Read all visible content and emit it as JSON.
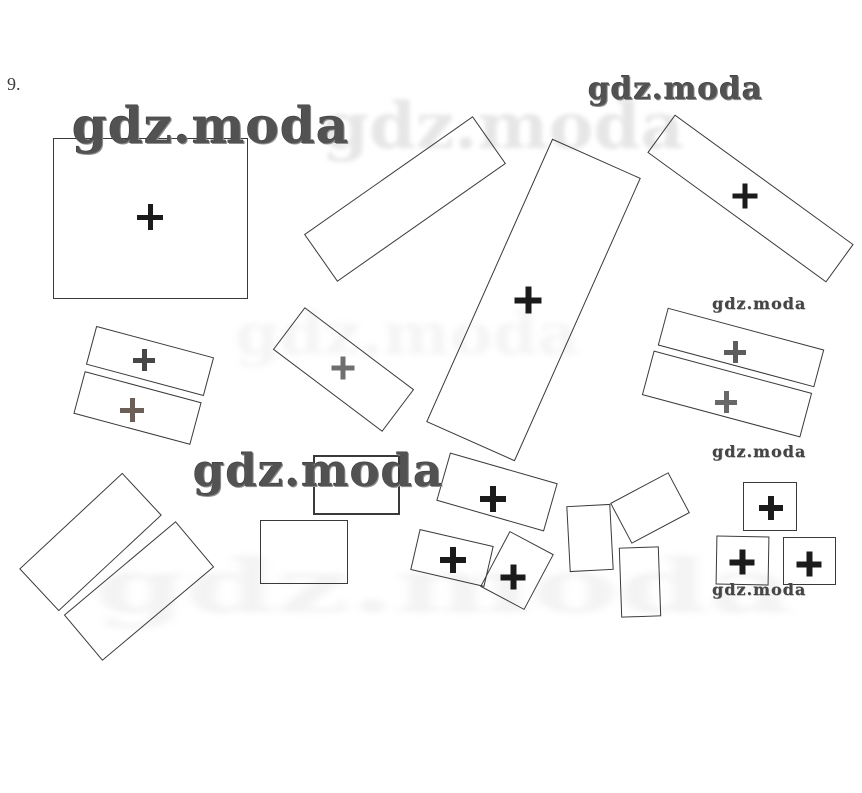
{
  "page": {
    "problem_number": "9.",
    "background": "#ffffff",
    "description": "Scanned workbook exercise: scattered rectangles, some marked with plus signs"
  },
  "watermark_text": "gdz.moda",
  "watermarks": [
    {
      "text": "gdz.moda",
      "x": 72,
      "y": 101,
      "font": 50,
      "style": "big"
    },
    {
      "text": "gdz.moda",
      "x": 193,
      "y": 448,
      "font": 45,
      "style": "big"
    },
    {
      "text": "gdz.moda",
      "x": 588,
      "y": 74,
      "font": 31,
      "style": "big"
    },
    {
      "text": "gdz.moda",
      "x": 712,
      "y": 296,
      "font": 16,
      "style": "small"
    },
    {
      "text": "gdz.moda",
      "x": 712,
      "y": 444,
      "font": 16,
      "style": "small"
    },
    {
      "text": "gdz.moda",
      "x": 712,
      "y": 582,
      "font": 16,
      "style": "small"
    }
  ],
  "colors": {
    "line": "#3a3a3a",
    "plus_black": "#1b1b1b",
    "plus_gray": "#6f6f6f",
    "watermark_dark": "#525252"
  },
  "figure": {
    "rectangles": [
      {
        "name": "rect-large-square-top-left",
        "cx": 150,
        "cy": 218,
        "w": 195,
        "h": 161,
        "rot": 0,
        "stroke": 1.5
      },
      {
        "name": "rect-thin-left-upper",
        "cx": 150,
        "cy": 361,
        "w": 122,
        "h": 40,
        "rot": 15,
        "stroke": 1.3
      },
      {
        "name": "rect-thin-left-lower",
        "cx": 137,
        "cy": 408,
        "w": 121,
        "h": 44,
        "rot": 15,
        "stroke": 1.3
      },
      {
        "name": "rect-long-top-middle",
        "cx": 405,
        "cy": 199,
        "w": 206,
        "h": 58,
        "rot": -35,
        "stroke": 1.2
      },
      {
        "name": "rect-tall-middle",
        "cx": 533,
        "cy": 300,
        "w": 97,
        "h": 310,
        "rot": 24,
        "stroke": 1.3
      },
      {
        "name": "rect-long-top-right",
        "cx": 750,
        "cy": 198,
        "w": 221,
        "h": 47,
        "rot": 36,
        "stroke": 1.3
      },
      {
        "name": "rect-thin-right-upper",
        "cx": 741,
        "cy": 347,
        "w": 162,
        "h": 39,
        "rot": 15,
        "stroke": 1.4
      },
      {
        "name": "rect-thin-right-lower",
        "cx": 727,
        "cy": 394,
        "w": 164,
        "h": 46,
        "rot": 15,
        "stroke": 1.4
      },
      {
        "name": "rect-middle-rotated",
        "cx": 343,
        "cy": 369,
        "w": 137,
        "h": 53,
        "rot": 37,
        "stroke": 1.2
      },
      {
        "name": "rect-under-watermark",
        "cx": 356,
        "cy": 485,
        "w": 87,
        "h": 60,
        "rot": 0,
        "stroke": 2.4
      },
      {
        "name": "rect-below-watermark",
        "cx": 304,
        "cy": 552,
        "w": 88,
        "h": 64,
        "rot": 0,
        "stroke": 1.5
      },
      {
        "name": "rect-plus-middle",
        "cx": 497,
        "cy": 492,
        "w": 112,
        "h": 50,
        "rot": 16,
        "stroke": 1.4
      },
      {
        "name": "rect-plus-small-left",
        "cx": 452,
        "cy": 558,
        "w": 76,
        "h": 42,
        "rot": 13,
        "stroke": 1.3
      },
      {
        "name": "rect-plus-small-square",
        "cx": 517,
        "cy": 570,
        "w": 50,
        "h": 63,
        "rot": 28,
        "stroke": 1.3
      },
      {
        "name": "rect-small-vertical-1",
        "cx": 590,
        "cy": 538,
        "w": 44,
        "h": 66,
        "rot": -3,
        "stroke": 1.3
      },
      {
        "name": "rect-small-rotated-right",
        "cx": 650,
        "cy": 508,
        "w": 66,
        "h": 46,
        "rot": -28,
        "stroke": 1.4
      },
      {
        "name": "rect-small-vertical-2",
        "cx": 640,
        "cy": 582,
        "w": 40,
        "h": 70,
        "rot": -2,
        "stroke": 1.3
      },
      {
        "name": "square-right-top",
        "cx": 770,
        "cy": 506,
        "w": 54,
        "h": 49,
        "rot": 0,
        "stroke": 1.8
      },
      {
        "name": "square-right-bottom-left",
        "cx": 742,
        "cy": 560,
        "w": 53,
        "h": 49,
        "rot": 1,
        "stroke": 1.8
      },
      {
        "name": "square-right-bottom-right",
        "cx": 809,
        "cy": 561,
        "w": 53,
        "h": 48,
        "rot": 0,
        "stroke": 1.8
      },
      {
        "name": "rect-bottom-left-upper",
        "cx": 90,
        "cy": 542,
        "w": 141,
        "h": 58,
        "rot": -43,
        "stroke": 1.2
      },
      {
        "name": "rect-bottom-left-lower",
        "cx": 139,
        "cy": 591,
        "w": 146,
        "h": 60,
        "rot": -40,
        "stroke": 1.2
      }
    ],
    "plus_marks": [
      {
        "x": 150,
        "y": 217,
        "color": "#1b1b1b",
        "size": 26,
        "arm": 5
      },
      {
        "x": 528,
        "y": 300,
        "color": "#1b1b1b",
        "size": 27,
        "arm": 6
      },
      {
        "x": 745,
        "y": 196,
        "color": "#1b1b1b",
        "size": 25,
        "arm": 5
      },
      {
        "x": 493,
        "y": 499,
        "color": "#1b1b1b",
        "size": 26,
        "arm": 6
      },
      {
        "x": 453,
        "y": 560,
        "color": "#1b1b1b",
        "size": 26,
        "arm": 6
      },
      {
        "x": 513,
        "y": 577,
        "color": "#1b1b1b",
        "size": 25,
        "arm": 6
      },
      {
        "x": 771,
        "y": 508,
        "color": "#1b1b1b",
        "size": 24,
        "arm": 6
      },
      {
        "x": 742,
        "y": 562,
        "color": "#1b1b1b",
        "size": 25,
        "arm": 6
      },
      {
        "x": 809,
        "y": 564,
        "color": "#1b1b1b",
        "size": 25,
        "arm": 6
      },
      {
        "x": 144,
        "y": 360,
        "color": "#474747",
        "size": 22,
        "arm": 5
      },
      {
        "x": 132,
        "y": 410,
        "color": "#6c5f58",
        "size": 24,
        "arm": 5
      },
      {
        "x": 343,
        "y": 368,
        "color": "#6f6f6f",
        "size": 23,
        "arm": 5
      },
      {
        "x": 735,
        "y": 352,
        "color": "#5d5d5d",
        "size": 22,
        "arm": 5
      },
      {
        "x": 726,
        "y": 402,
        "color": "#686868",
        "size": 22,
        "arm": 5
      }
    ],
    "ghosts": [
      {
        "text": "gdz.moda",
        "x": 322,
        "y": 95,
        "font": 64,
        "opacity": 0.28,
        "blur": 2,
        "sx": 1.05,
        "color": "#a8a8a8"
      },
      {
        "text": "gdz.moda",
        "x": 235,
        "y": 305,
        "font": 58,
        "opacity": 0.13,
        "blur": 3,
        "sx": 1.1,
        "color": "#b0b0b0"
      },
      {
        "text": "gdz.moda",
        "x": 95,
        "y": 550,
        "font": 74,
        "opacity": 0.15,
        "blur": 3,
        "sx": 1.75,
        "color": "#b0b0b0"
      }
    ]
  }
}
